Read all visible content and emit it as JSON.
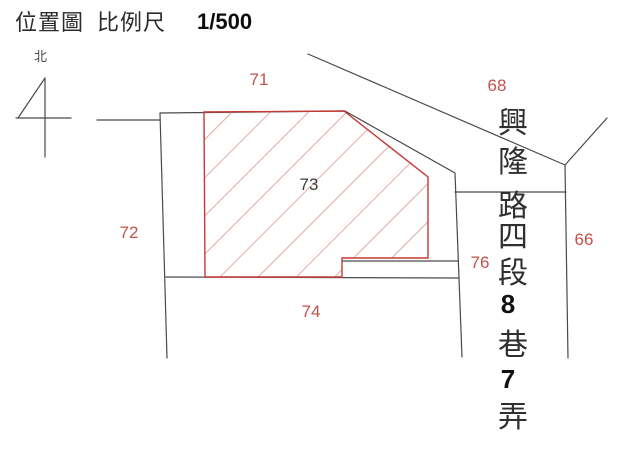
{
  "header": {
    "title": "位置圖",
    "scale_label": "比例尺",
    "scale_value": "1/500"
  },
  "north": {
    "label": "北"
  },
  "street": {
    "name": "興隆路四段8巷7弄",
    "chars": [
      "興",
      "隆",
      "路",
      "四",
      "段",
      "8",
      "巷",
      "7",
      "弄"
    ]
  },
  "parcels": {
    "subject": {
      "number": "73",
      "hatched": true
    },
    "neighbors": [
      {
        "number": "71"
      },
      {
        "number": "68"
      },
      {
        "number": "72"
      },
      {
        "number": "66"
      },
      {
        "number": "76"
      },
      {
        "number": "74"
      }
    ]
  },
  "colors": {
    "boundary_line": "#4a4a4a",
    "parcel_outline": "#c43a36",
    "parcel_hatch": "#db8f8d",
    "neighbor_label": "#c4504c",
    "subject_label": "#3d3d3d",
    "background": "#ffffff"
  }
}
